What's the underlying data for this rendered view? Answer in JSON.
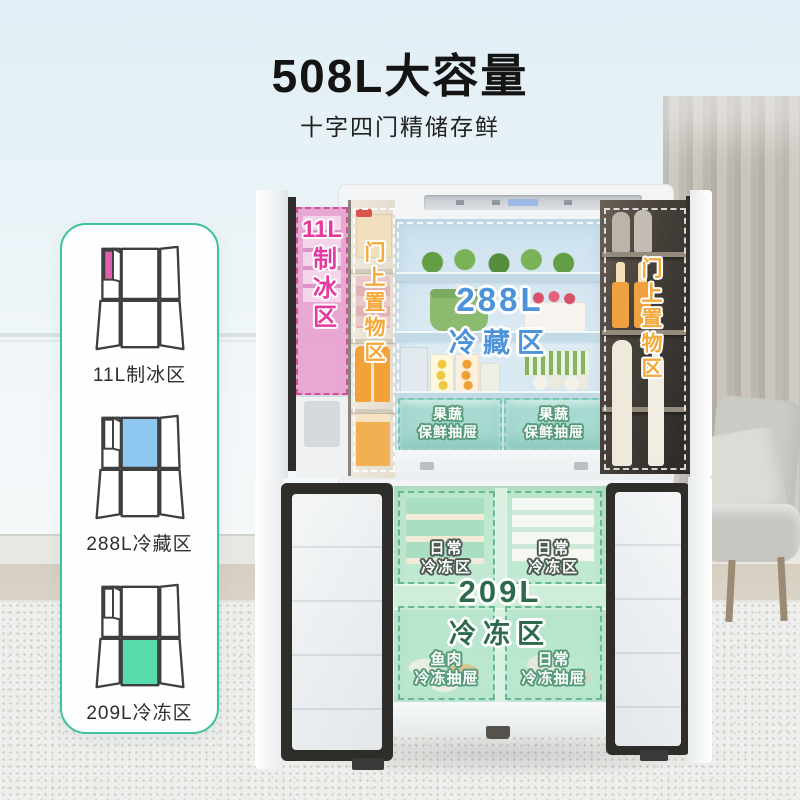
{
  "page": {
    "title": "508L大容量",
    "subtitle": "十字四门精储存鲜"
  },
  "colors": {
    "card_border": "#3cc29c",
    "ice_label": "#e5399f",
    "door_bin_label": "#f3a93c",
    "fresh_label": "#4e93d9",
    "freezer_label": "#2e6b4c",
    "freezer_tint": "#bce6cc",
    "crisper_tint": "#96d6c6"
  },
  "legend": {
    "items": [
      {
        "label": "11L制冰区",
        "highlight_color": "#e060ae",
        "zone": "ice-maker"
      },
      {
        "label": "288L冷藏区",
        "highlight_color": "#8ec7f0",
        "zone": "fridge"
      },
      {
        "label": "209L冷冻区",
        "highlight_color": "#59dcab",
        "zone": "freezer"
      }
    ]
  },
  "fridge": {
    "ice_zone": {
      "line1": "11L",
      "vertical": "制冰区"
    },
    "left_door_bin": {
      "vertical": "门上置物区"
    },
    "fresh_zone": {
      "size": "288L",
      "name": "冷藏区"
    },
    "crisper_drawers": [
      {
        "line1": "果蔬",
        "line2": "保鲜抽屉"
      },
      {
        "line1": "果蔬",
        "line2": "保鲜抽屉"
      }
    ],
    "right_door_bin": {
      "vertical": "门上置物区"
    },
    "freezer_daily_zones": [
      {
        "line1": "日常",
        "line2": "冷冻区"
      },
      {
        "line1": "日常",
        "line2": "冷冻区"
      }
    ],
    "freezer_zone": {
      "size": "209L",
      "name": "冷冻区"
    },
    "freezer_drawers": [
      {
        "line1": "鱼肉",
        "line2": "冷冻抽屉"
      },
      {
        "line1": "日常",
        "line2": "冷冻抽屉"
      }
    ]
  }
}
